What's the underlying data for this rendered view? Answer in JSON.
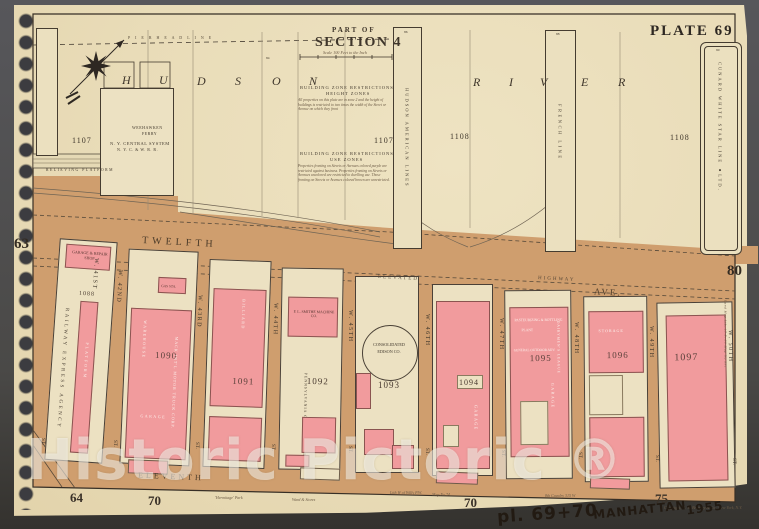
{
  "plate": "PLATE 69",
  "title": {
    "part": "PART OF",
    "section": "SECTION 4",
    "scale": "Scale 100 Feet to the Inch"
  },
  "river": {
    "l1": "H",
    "l2": "U",
    "l3": "D",
    "l4": "S",
    "l5": "O",
    "l6": "N",
    "r1": "R",
    "r2": "I",
    "r3": "V",
    "r4": "E",
    "r5": "R",
    "pierhead": "P I E R H E A D   L I N E"
  },
  "piers": {
    "hudson_american": "HUDSON AMERICAN LINES",
    "french": "FRENCH LINE",
    "cunard": "CUNARD WHITE STAR LINE ●LTD.",
    "n84": "84",
    "n86": "86",
    "n88": "88",
    "n90": "90"
  },
  "parcels": {
    "a": "1107",
    "b": "1107",
    "c": "1108",
    "d": "1108"
  },
  "restrictions": {
    "t1": "BUILDING ZONE RESTRICTIONS",
    "t1b": "HEIGHT ZONES",
    "b1": "All properties on this plate are in zone 2 and the height of buildings is restricted to two times the width of the Street or Avenue on which they front",
    "t2": "BUILDING ZONE RESTRICTIONS",
    "t2b": "USE ZONES",
    "b2": "Properties fronting on Streets or Avenues colored purple are restricted against business. Properties fronting on Streets or Avenues uncolored are restricted to dwelling use. Those fronting on Streets or Avenues colored brown are unrestricted."
  },
  "ferry": {
    "n1": "WEEHAWKEN",
    "n2": "FERRY",
    "o1": "N. Y. CENTRAL SYSTEM",
    "o2": "N. Y. C. & W. R. R.",
    "platform": "RELIEVING PLATFORM"
  },
  "avenues": {
    "twelfth": "TWELFTH",
    "ave": "AVE.",
    "elevated": "ELEVATED",
    "highway": "HIGHWAY",
    "eleventh": "ELEVENTH"
  },
  "streets": [
    {
      "name": "W. 41ST"
    },
    {
      "name": "W. 42ND"
    },
    {
      "name": "W. 43RD"
    },
    {
      "name": "W. 44TH"
    },
    {
      "name": "W. 45TH"
    },
    {
      "name": "W. 46TH"
    },
    {
      "name": "W. 47TH"
    },
    {
      "name": "W. 48TH"
    },
    {
      "name": "W. 49TH"
    },
    {
      "name": "W. 50TH"
    }
  ],
  "st_suffix": "ST.",
  "blocks": [
    {
      "number": "1088",
      "garage_shop": "GARAGE & REPAIR SHOP",
      "agency": "RAILWAY EXPRESS AGENCY",
      "platform": "PLATFORM"
    },
    {
      "number": "1090",
      "gas": "GAS STA.",
      "warehouse": "WAREHOUSE",
      "mack": "MACK INT'L MOTOR TRUCK CORP.",
      "garage": "GARAGE"
    },
    {
      "number": "1091",
      "billiard": "BILLIARD"
    },
    {
      "number": "1092",
      "smithe": "F. L. SMITHE MACHINE CO.",
      "greyhound": "PENNSYLVANIA GREYHOUND LINES"
    },
    {
      "number": "1093",
      "coned1": "CONSOLIDATED",
      "coned2": "EDISON CO."
    },
    {
      "number": "1094",
      "garage": "GARAGE"
    },
    {
      "number": "1095",
      "past": "PASTEURIZING & BOTTLING",
      "plant": "PLANT",
      "outdoor": "GENERAL OUTDOOR ADV.",
      "dairy": "DAIRYMEN'S LEAGUE",
      "garage": "GARAGE"
    },
    {
      "number": "1096",
      "storage": "STORAGE"
    },
    {
      "number": "1097"
    }
  ],
  "margins": {
    "left": "63",
    "right": "80",
    "b1": "64",
    "b2": "70",
    "b3": "70",
    "b4": "75"
  },
  "marginalia": {
    "m1": "'Hermitage' Park",
    "m2": "Ward & Stores",
    "m3": "Lith W of Willy P.W.",
    "m4": "Map No 74",
    "m5": "8th Cavalry 315 W",
    "side": "Land Map Lib. 17 P. 39 Map No 891",
    "copyright": "Copyright, G. W. Bromley & Co., New York, N.Y."
  },
  "handwriting": {
    "a": "pl. 69+70",
    "b": "MANHATTAN",
    "c": "1955"
  },
  "watermark": "Historic Pictoric ®",
  "colors": {
    "paper": "#e9dcb8",
    "river": "#ece2c2",
    "tan": "#cf9e6e",
    "pink": "#f19b9d",
    "ink": "#3b332a",
    "background": "#4a4a4e"
  }
}
